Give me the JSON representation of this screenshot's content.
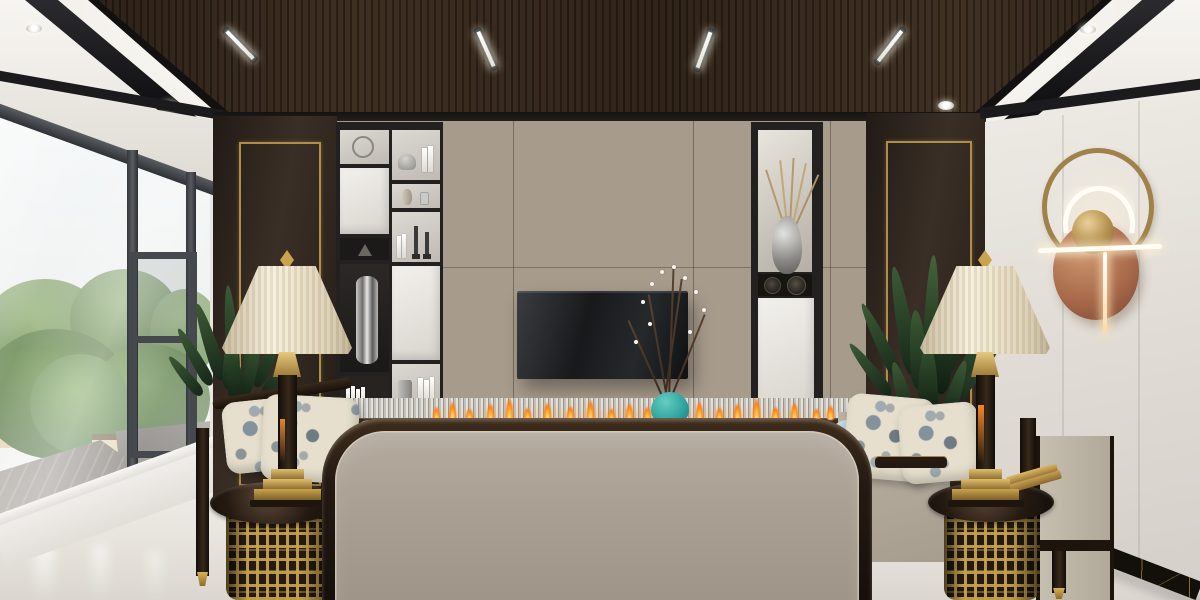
{
  "scene": {
    "type": "photorealistic 3D interior render, no visible text",
    "room": "modern new-Chinese style living room",
    "description": "Symmetrical living room render: dark coffered wood ceiling with linear spotlights and white cove lighting; concrete-panel TV wall with wall-mounted black TV over a linear ethanol fireplace with small orange flames and a fluted metal band; black display shelving with white doors, books and silver vases on the left, a lit display niche with a silver vase of dried stems on the right; dark wood side pillars with gold inlay frames; large left window with black frames looking onto lush green trees and rooftops; right wall of light stone tiles with a brass ring-and-copper-disc wall sconce and black-gold marble baseboard; two cream pleated bell table lamps on black-topped gold fretwork drum side tables; flanking armchairs in dark wood with cream upholstery, blue-gray floral pillows and light blue cushions; green plants behind each chair; wide taupe upholstered sofa back with espresso wood trim and rounded corners in the foreground on a polished light marble floor.",
    "text_content": "none"
  },
  "palette": {
    "ceiling_wood": "#2f2217",
    "ceiling_trim_black": "#141416",
    "cove_white": "#fbfaf6",
    "wall_greige": "#e2ded6",
    "concrete_panel": "#a79b8c",
    "dark_wood_panel": "#2e251e",
    "gold_accent": "#b08d4a",
    "shelf_black": "#23211f",
    "shelf_white": "#eceae5",
    "tv_black": "#1b1d1f",
    "sofa_fabric_taupe": "#a89e92",
    "sofa_trim_espresso": "#2a1d13",
    "cushion_blue": "#a9cdd9",
    "pillow_cream": "#e3dccb",
    "lamp_shade_cream": "#f2ead6",
    "brass": "#c9a254",
    "copper_disc": "#a96b4b",
    "vase_teal": "#3db3ac",
    "flame_orange": "#ff8c1f",
    "floor_marble": "#e9e6e1",
    "baseboard_marble": "#14110d",
    "window_frame": "#3d4145",
    "foliage_green": "#4c6b3f"
  },
  "objects": [
    "coffered-wood-ceiling",
    "linear-ceiling-spotlights",
    "cove-lighting",
    "recessed-downlights",
    "window-wall",
    "tree-view",
    "rooftops",
    "tv-wall-concrete-panels",
    "television",
    "display-shelving",
    "display-niche",
    "gold-inlay-pillars",
    "fluted-metal-band",
    "linear-fireplace",
    "teal-vase-with-branches",
    "ring-wall-sconce",
    "stone-tile-wall",
    "marble-baseboard",
    "table-lamp-left",
    "table-lamp-right",
    "fretwork-side-table-left",
    "fretwork-side-table-right",
    "armchair-left",
    "armchair-right",
    "floral-pillows",
    "blue-cushions",
    "potted-plants",
    "sofa-back",
    "marble-floor"
  ]
}
